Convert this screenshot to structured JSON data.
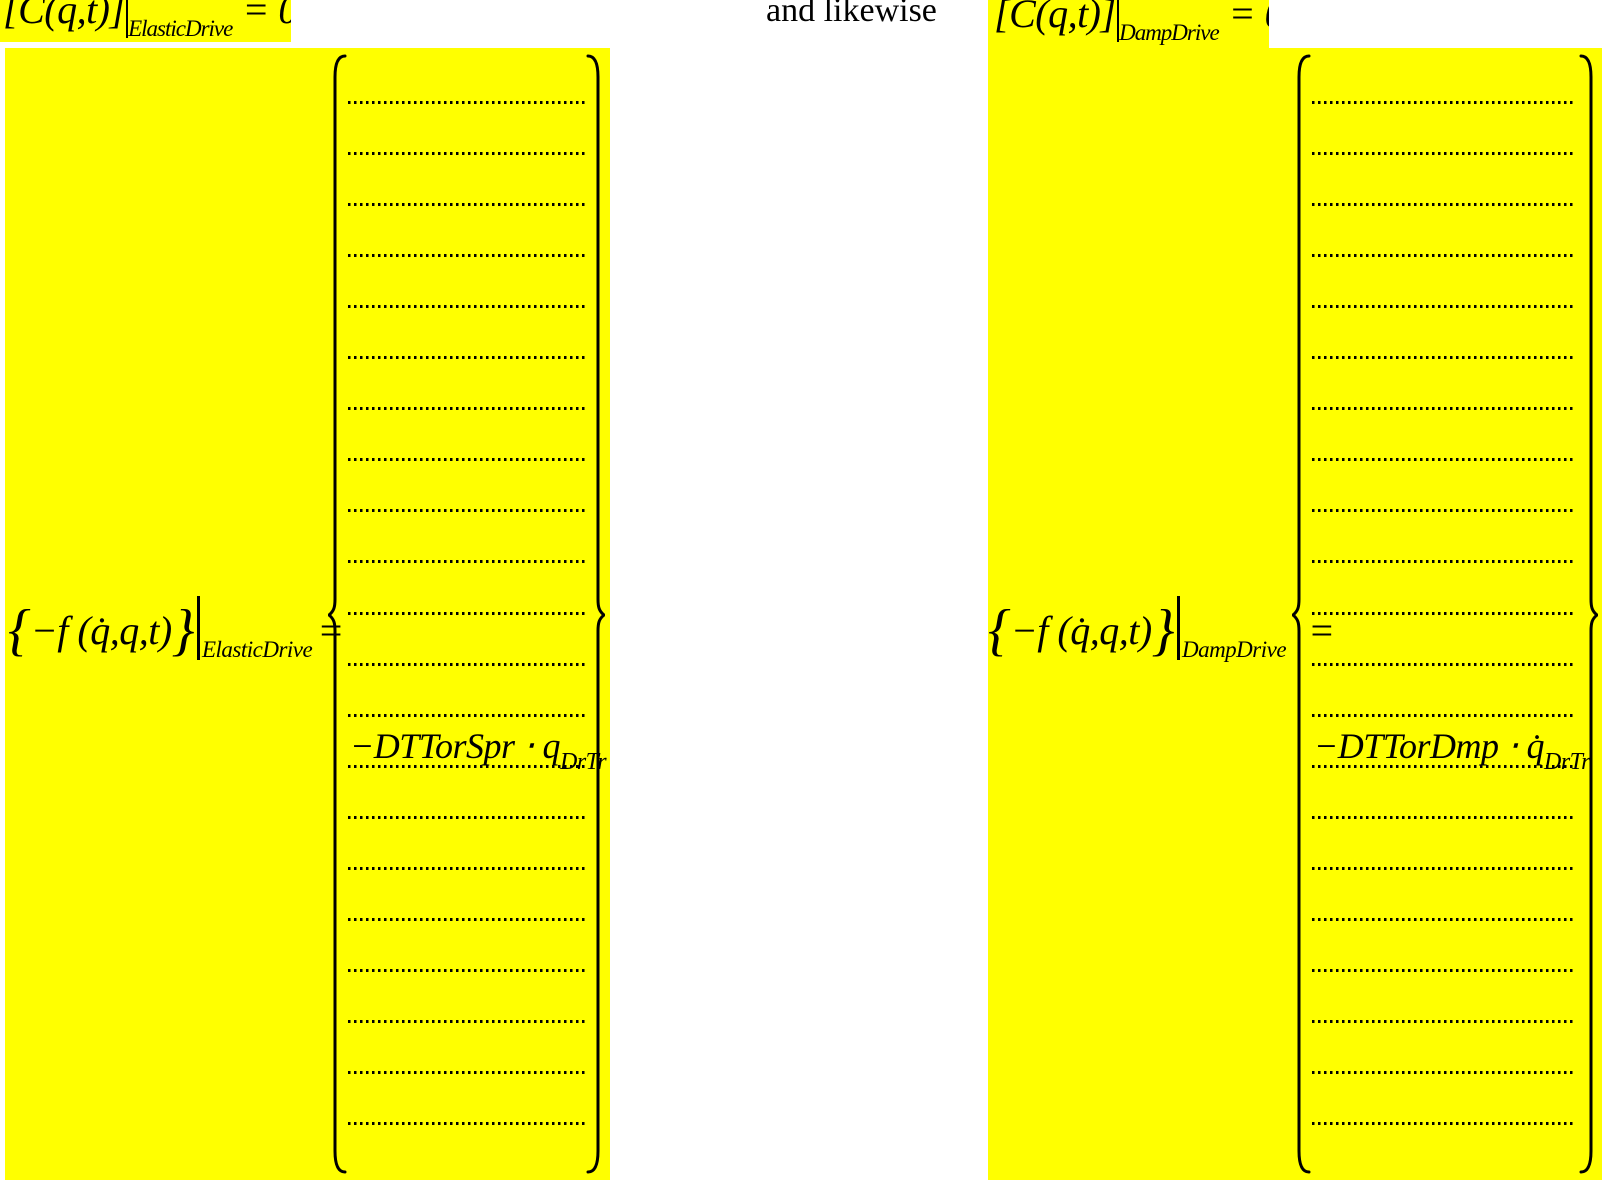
{
  "document": {
    "background": "#ffffff",
    "highlight_color": "#ffff00",
    "text_color": "#000000"
  },
  "header": {
    "left_constraint": {
      "expr": "[C(q,t)]",
      "subscript": "ElasticDrive",
      "rhs": "= 0"
    },
    "connector": "and likewise",
    "right_constraint": {
      "expr": "[C(q,t)]",
      "subscript": "DampDrive",
      "rhs": "= 0"
    }
  },
  "systems": [
    {
      "id": "elastic-drive",
      "lhs": {
        "open_brace": "{",
        "body": "−f (q̇,q,t)",
        "close_brace": "}",
        "subscript": "ElasticDrive",
        "equals": "="
      },
      "vector": {
        "dotted_rows": 21,
        "entry_after_row": 13,
        "entry_base": "−DTTorSpr ⋅ q",
        "entry_sub": "DrTr"
      }
    },
    {
      "id": "damp-drive",
      "lhs": {
        "open_brace": "{",
        "body": "−f (q̇,q,t)",
        "close_brace": "}",
        "subscript": "DampDrive",
        "equals": "="
      },
      "vector": {
        "dotted_rows": 21,
        "entry_after_row": 13,
        "entry_base": "−DTTorDmp ⋅ q̇",
        "entry_sub": "DrTr"
      }
    }
  ]
}
